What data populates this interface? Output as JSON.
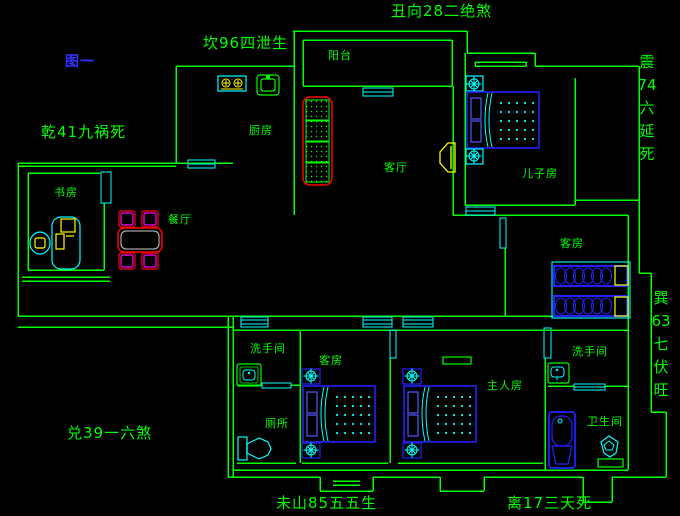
{
  "window_title": "户型风水图",
  "colors": {
    "background": "#000000",
    "wall": "#00ff00",
    "window_door": "#00ffff",
    "furniture_blue": "#2222ff",
    "pillow_blue": "#5555ff",
    "pattern_cyan": "#00ffff",
    "sofa_red": "#ff0000",
    "yellow": "#ffff00",
    "magenta": "#ff00ff",
    "table_inner": "#cccccc",
    "label_green": "#00ff00",
    "figure_blue": "#3333ff"
  },
  "annotations": {
    "figure": "图一",
    "chou": "丑向28二绝煞",
    "kan": "坎96四泄生",
    "qian": "乾41九祸死",
    "zhen": "震\n74\n六\n延\n死",
    "xun": "巽\n63\n七\n伏\n旺",
    "dui": "兑39一六煞",
    "wei": "未山85五五生",
    "li": "离17三天死"
  },
  "rooms": {
    "balcony": "阳台",
    "kitchen": "厨房",
    "living": "客厅",
    "son": "儿子房",
    "study": "书房",
    "dining": "餐厅",
    "guest_east": "客房",
    "washroom_west": "洗手间",
    "guest_south": "客房",
    "master": "主人房",
    "washroom_east": "洗手间",
    "toilet": "厕所",
    "bathroom": "卫生间"
  }
}
